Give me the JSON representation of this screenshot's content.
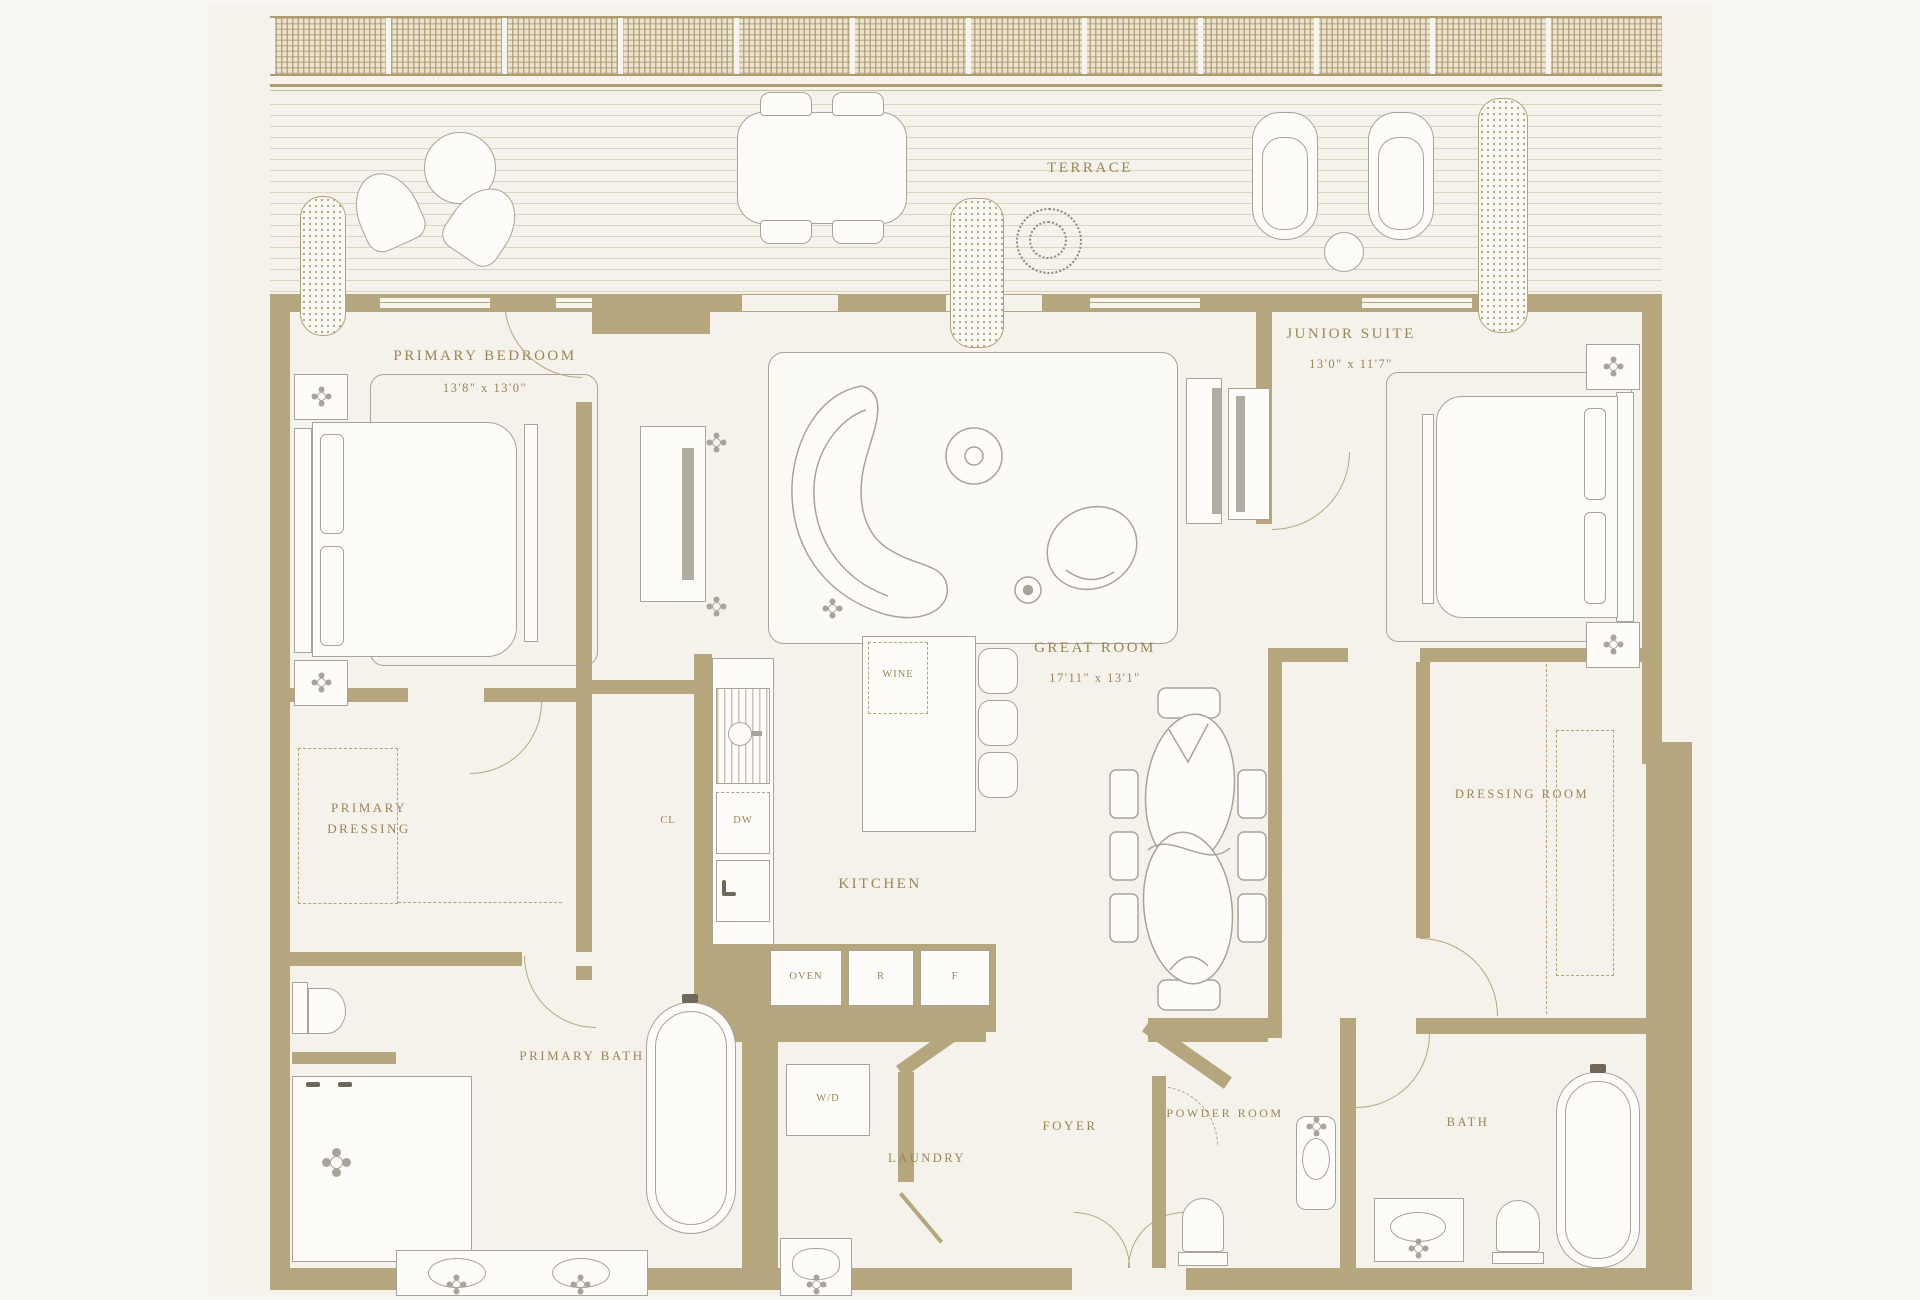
{
  "plan_title": "Residence Floor Plan",
  "colors": {
    "wall": "#b6a67e",
    "line": "#a9a39a",
    "text": "#9a8658",
    "floor": "#f4f2ea"
  },
  "rooms": {
    "terrace": {
      "label": "TERRACE"
    },
    "primary_bedroom": {
      "label": "PRIMARY BEDROOM",
      "dims": "13'8\" x 13'0\""
    },
    "junior_suite": {
      "label": "JUNIOR SUITE",
      "dims": "13'0\" x 11'7\""
    },
    "great_room": {
      "label": "GREAT ROOM",
      "dims": "17'11\" x 13'1\""
    },
    "kitchen": {
      "label": "KITCHEN"
    },
    "closet": {
      "label": "CL"
    },
    "primary_dressing": {
      "label": "PRIMARY DRESSING"
    },
    "primary_bath": {
      "label": "PRIMARY BATH"
    },
    "dressing_room": {
      "label": "DRESSING ROOM"
    },
    "bath": {
      "label": "BATH"
    },
    "laundry": {
      "label": "LAUNDRY"
    },
    "foyer": {
      "label": "FOYER"
    },
    "powder_room": {
      "label": "POWDER ROOM"
    }
  },
  "appliances": {
    "wine": "WINE",
    "dishwasher": "DW",
    "oven": "OVEN",
    "refrigerator": "R",
    "freezer": "F",
    "washer_dryer": "W/D"
  }
}
